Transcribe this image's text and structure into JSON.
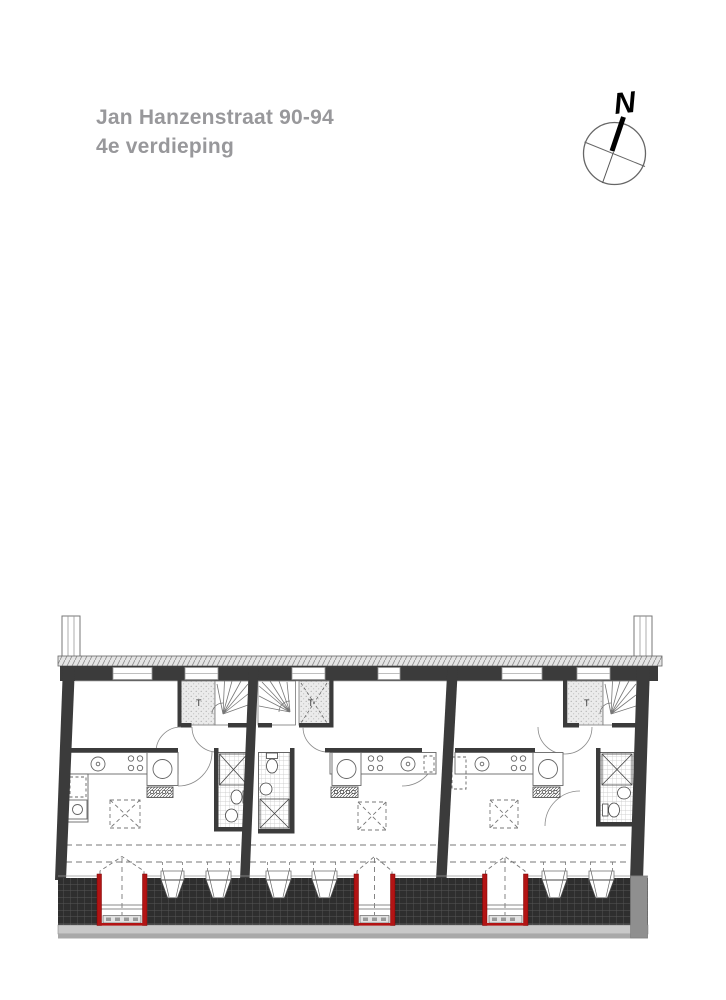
{
  "title": {
    "line1": "Jan Hanzenstraat 90-94",
    "line2": "4e verdieping"
  },
  "compass": {
    "north_label": "N"
  },
  "plan": {
    "type": "architectural-floor-plan",
    "units": [
      {
        "name": "unit-left",
        "shaft_label": "T"
      },
      {
        "name": "unit-middle",
        "shaft_label": "T"
      },
      {
        "name": "unit-right",
        "shaft_label": "T"
      }
    ],
    "colors": {
      "title_text": "#98989b",
      "wall_dark": "#3b3b3b",
      "roof_tile_band": "#2e2e2e",
      "door_accent_red": "#b31414",
      "shaft_fill": "#ebebeb",
      "gutter_gray": "#c8c8c8"
    }
  }
}
